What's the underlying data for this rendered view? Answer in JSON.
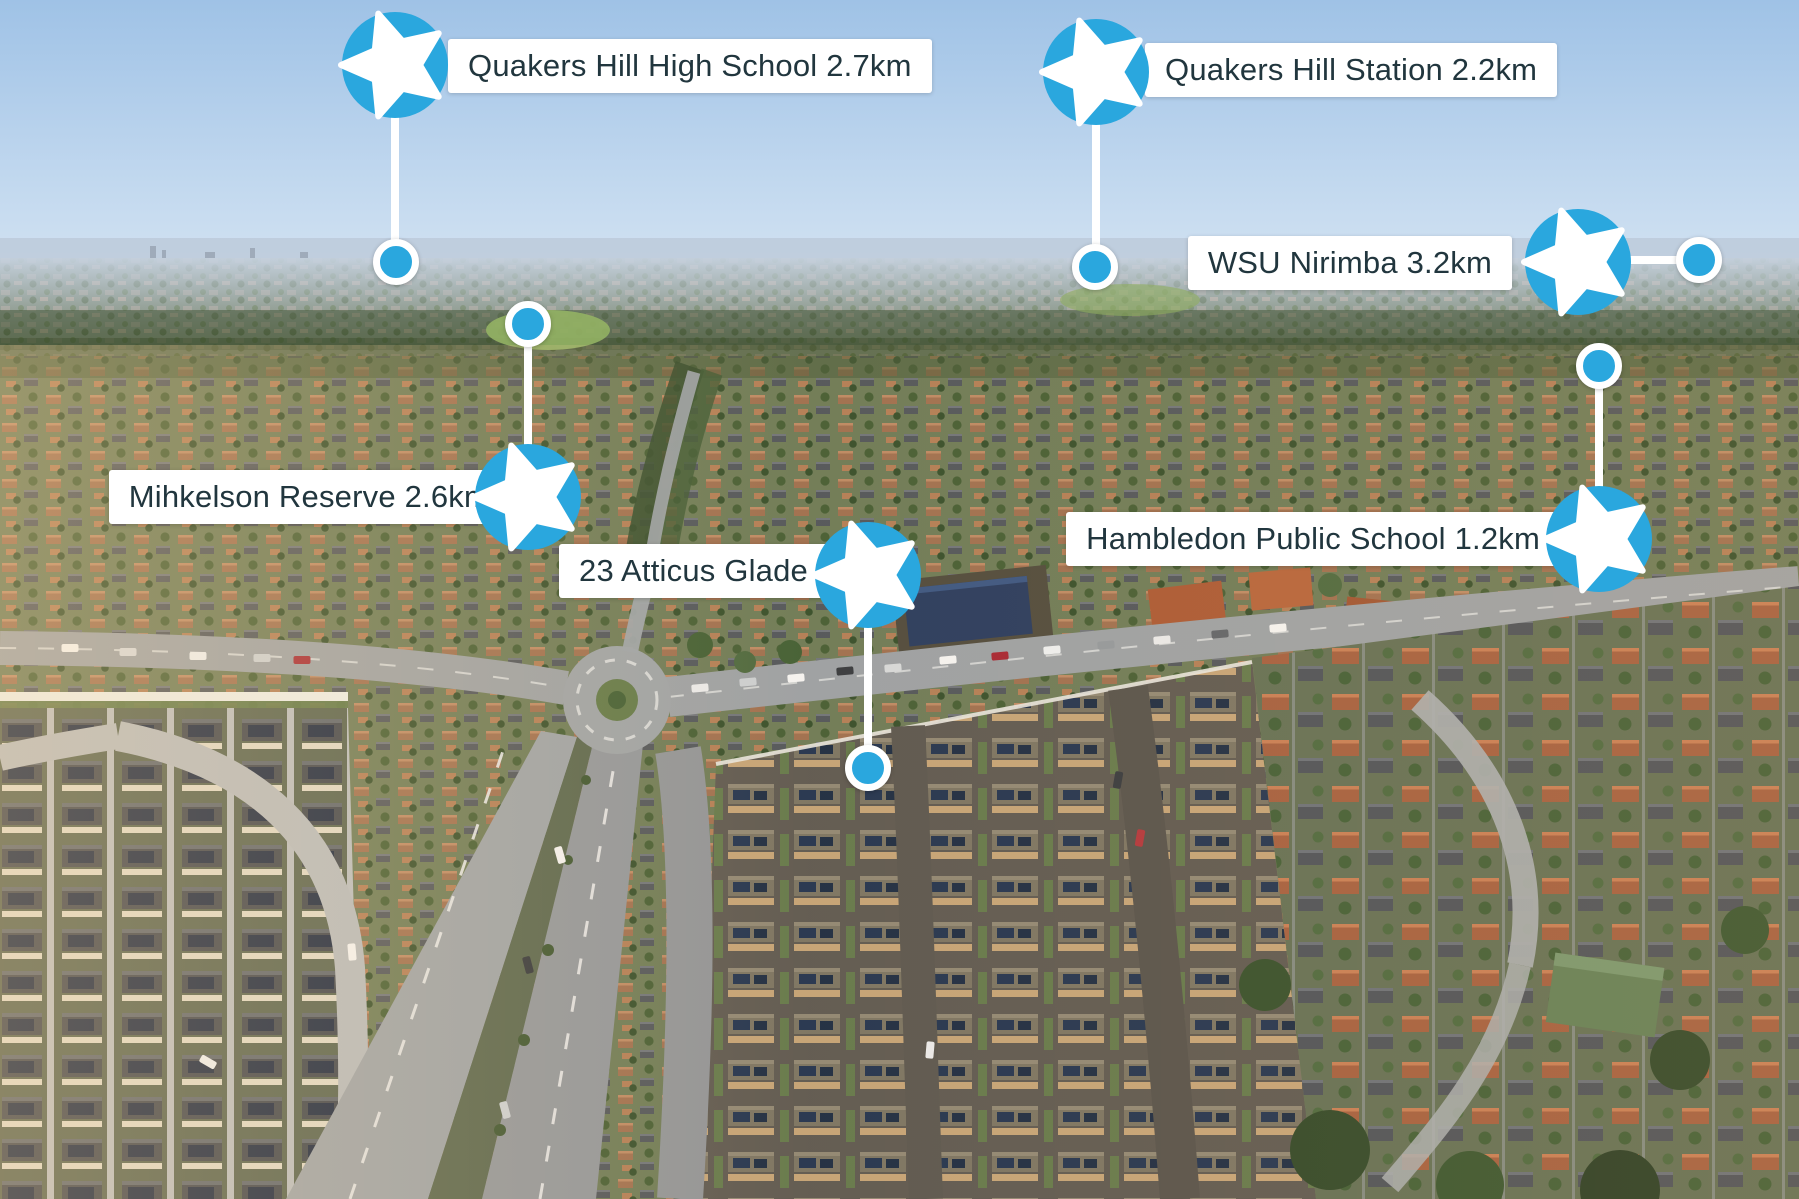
{
  "markers": [
    {
      "id": "quakers-hill-high-school",
      "label": "Quakers Hill High School 2.7km"
    },
    {
      "id": "quakers-hill-station",
      "label": "Quakers Hill Station 2.2km"
    },
    {
      "id": "wsu-nirimba",
      "label": "WSU Nirimba 3.2km"
    },
    {
      "id": "mihkelson-reserve",
      "label": "Mihkelson Reserve 2.6km"
    },
    {
      "id": "atticus-glade",
      "label": "23 Atticus Glade"
    },
    {
      "id": "hambledon-public-school",
      "label": "Hambledon Public School 1.2km"
    }
  ],
  "style": {
    "marker_blue": "#2aa7de",
    "star_white": "#ffffff",
    "connector_white": "#ffffff",
    "label_bg": "#ffffff",
    "label_text": "#21363e"
  }
}
